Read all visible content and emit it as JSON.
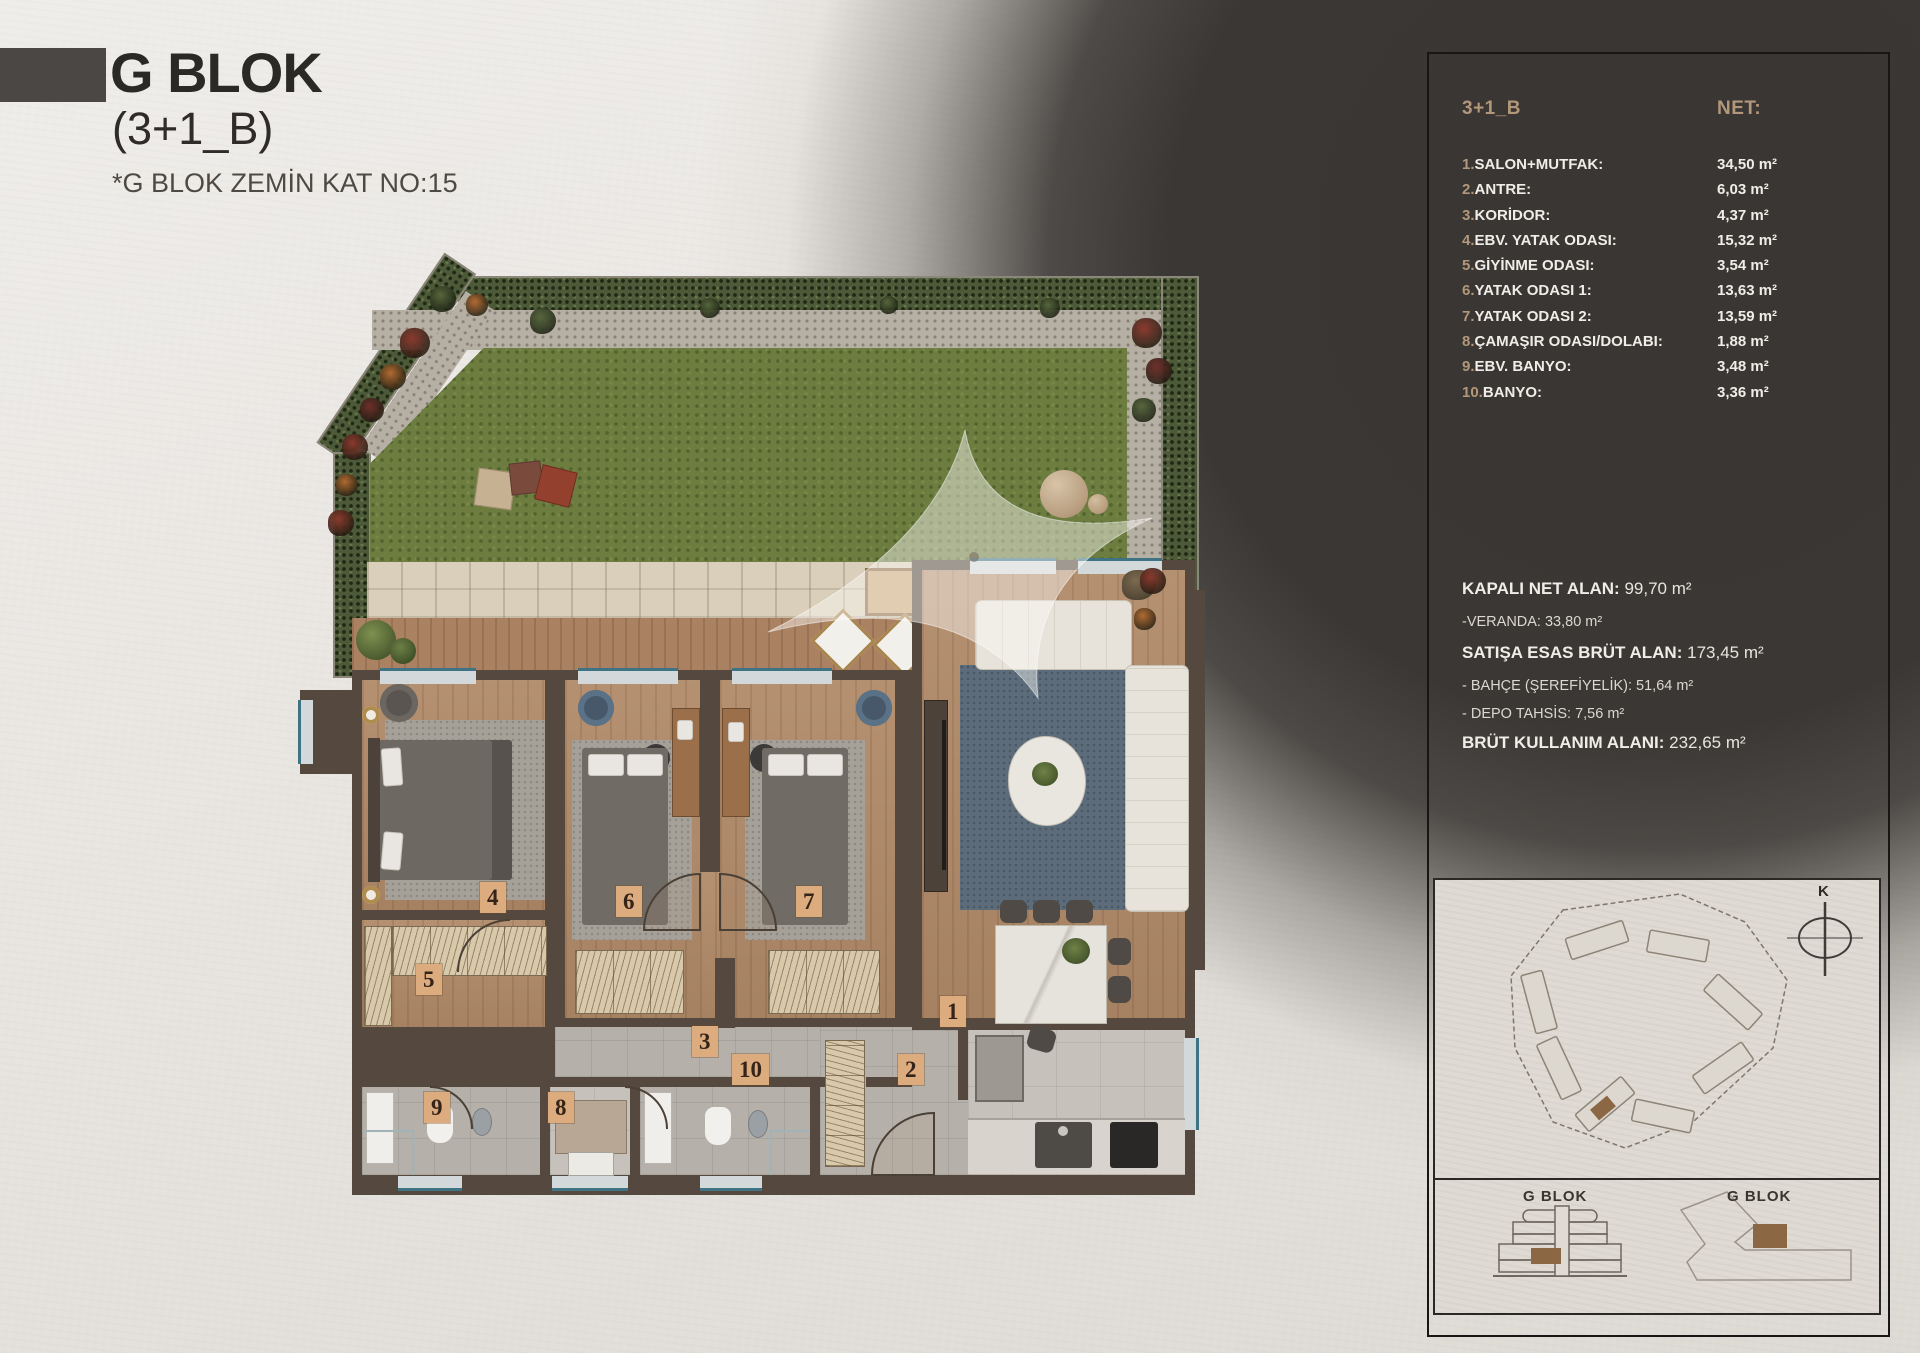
{
  "header": {
    "title": "G BLOK",
    "subtitle": "(3+1_B)",
    "note": "*G BLOK ZEMİN KAT NO:15"
  },
  "panel": {
    "plan_type": "3+1_B",
    "net_label": "NET:",
    "rooms": [
      {
        "num": "1.",
        "label": "SALON+MUTFAK:",
        "value": "34,50 m²"
      },
      {
        "num": "2.",
        "label": "ANTRE:",
        "value": "6,03 m²"
      },
      {
        "num": "3.",
        "label": "KORİDOR:",
        "value": "4,37 m²"
      },
      {
        "num": "4.",
        "label": "EBV. YATAK ODASI:",
        "value": "15,32 m²"
      },
      {
        "num": "5.",
        "label": "GİYİNME ODASI:",
        "value": "3,54 m²"
      },
      {
        "num": "6.",
        "label": "YATAK ODASI 1:",
        "value": "13,63 m²"
      },
      {
        "num": "7.",
        "label": "YATAK ODASI 2:",
        "value": "13,59 m²"
      },
      {
        "num": "8.",
        "label": "ÇAMAŞIR ODASI/DOLABI:",
        "value": "1,88 m²"
      },
      {
        "num": "9.",
        "label": "EBV. BANYO:",
        "value": "3,48 m²"
      },
      {
        "num": "10.",
        "label": "BANYO:",
        "value": "3,36 m²"
      }
    ],
    "summary": [
      {
        "label": "KAPALI NET ALAN:",
        "value": "99,70 m²",
        "style": "bold"
      },
      {
        "label": "-VERANDA: 33,80 m²",
        "value": "",
        "style": "dim"
      },
      {
        "label": "SATIŞA ESAS BRÜT ALAN:",
        "value": "173,45 m²",
        "style": "bold"
      },
      {
        "label": "- BAHÇE (ŞEREFİYELİK): 51,64 m²",
        "value": "",
        "style": "dim"
      },
      {
        "label": "- DEPO TAHSİS: 7,56 m²",
        "value": "",
        "style": "dim"
      },
      {
        "label": "BRÜT KULLANIM ALANI:",
        "value": "232,65 m²",
        "style": "bold"
      }
    ]
  },
  "site": {
    "compass": "K",
    "elevation_label": "G BLOK",
    "footprint_label": "G BLOK"
  },
  "floorplan": {
    "chips": [
      "4",
      "6",
      "7",
      "5",
      "3",
      "1",
      "2",
      "10",
      "8",
      "9"
    ]
  },
  "colors": {
    "accent_tan": "#b2977a",
    "panel_dark": "#3a3734",
    "chip": "#dcab7e",
    "highlight_brown": "#8b6744",
    "wall": "#55493f",
    "grass": "#6d7d40",
    "wood": "#b08a68",
    "rug_blue": "#5c6c7a",
    "window_glass": "#3d7383",
    "flower_red": "#8a3a2e",
    "flower_rust": "#b06a32",
    "flower_dark": "#6e2f2a",
    "flower_green": "#55663c"
  }
}
